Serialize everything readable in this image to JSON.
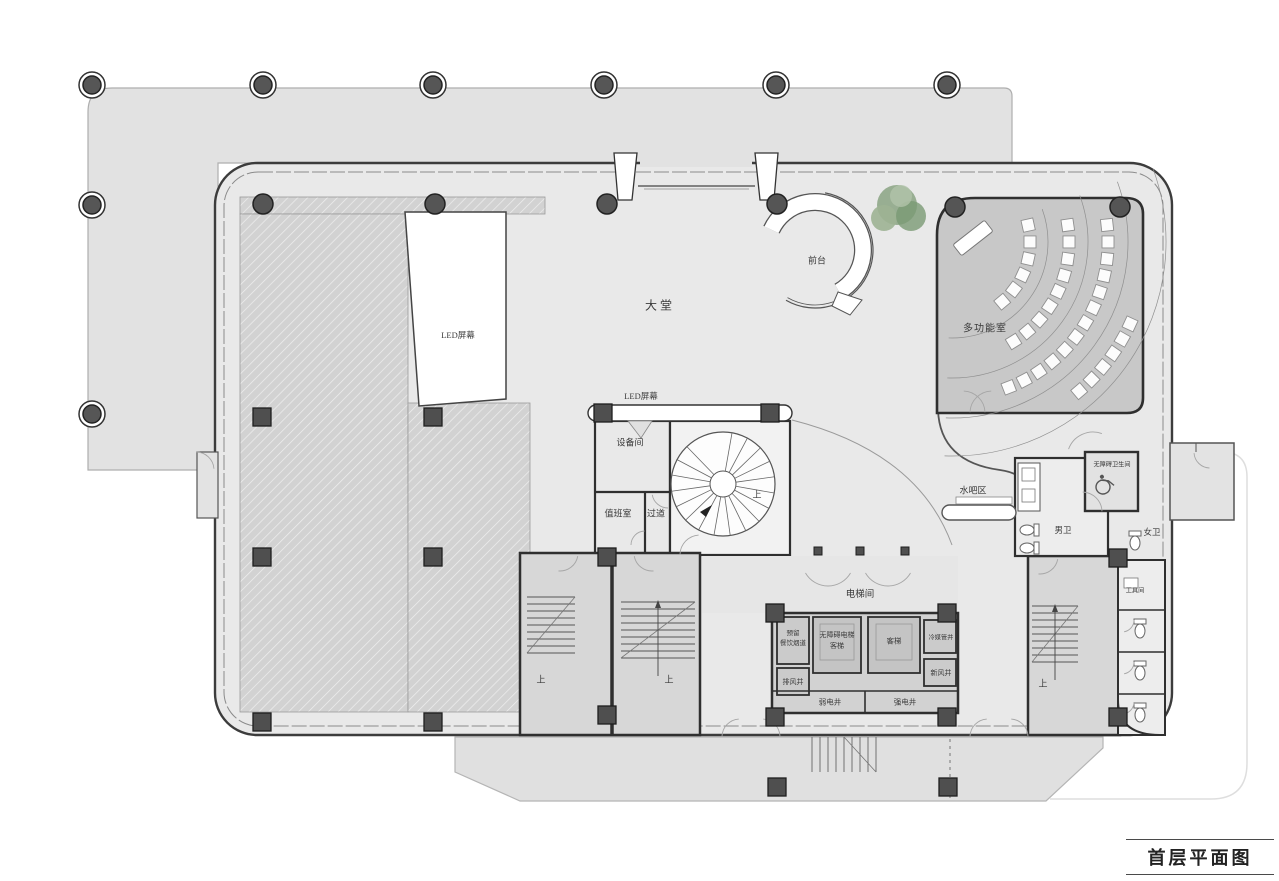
{
  "title": "首层平面图",
  "labels": {
    "lobby": "大堂",
    "reception": "前台",
    "multifunction_room": "多功能室",
    "led_screen": "LED屏幕",
    "equipment_room": "设备间",
    "duty_room": "值班室",
    "corridor": "过道",
    "water_bar": "水吧区",
    "accessible_wc": "无障碍卫生间",
    "male_wc": "男卫",
    "female_wc": "女卫",
    "elevator_hall": "电梯间",
    "reserved_flue_line1": "预留",
    "reserved_flue_line2": "餐饮烟道",
    "accessible_elevator_line1": "无障碍电梯",
    "accessible_elevator_line2": "客梯",
    "passenger_elevator": "客梯",
    "refrigerant_shaft": "冷媒管井",
    "exhaust_shaft": "排风井",
    "fresh_air_shaft": "新风井",
    "weak_current_shaft": "弱电井",
    "strong_current_shaft": "强电井",
    "tool_room": "工具间",
    "up": "上"
  },
  "colors": {
    "wall": "#2f2f2f",
    "floor": "#e9e9e9",
    "canopy": "#e2e2e2",
    "hatch_base": "#d2d2d2",
    "multifunction_fill": "#c8c8c8",
    "stair_fill": "#d6d6d6",
    "tree_green": "#8aa383",
    "column_fill": "#565656"
  }
}
